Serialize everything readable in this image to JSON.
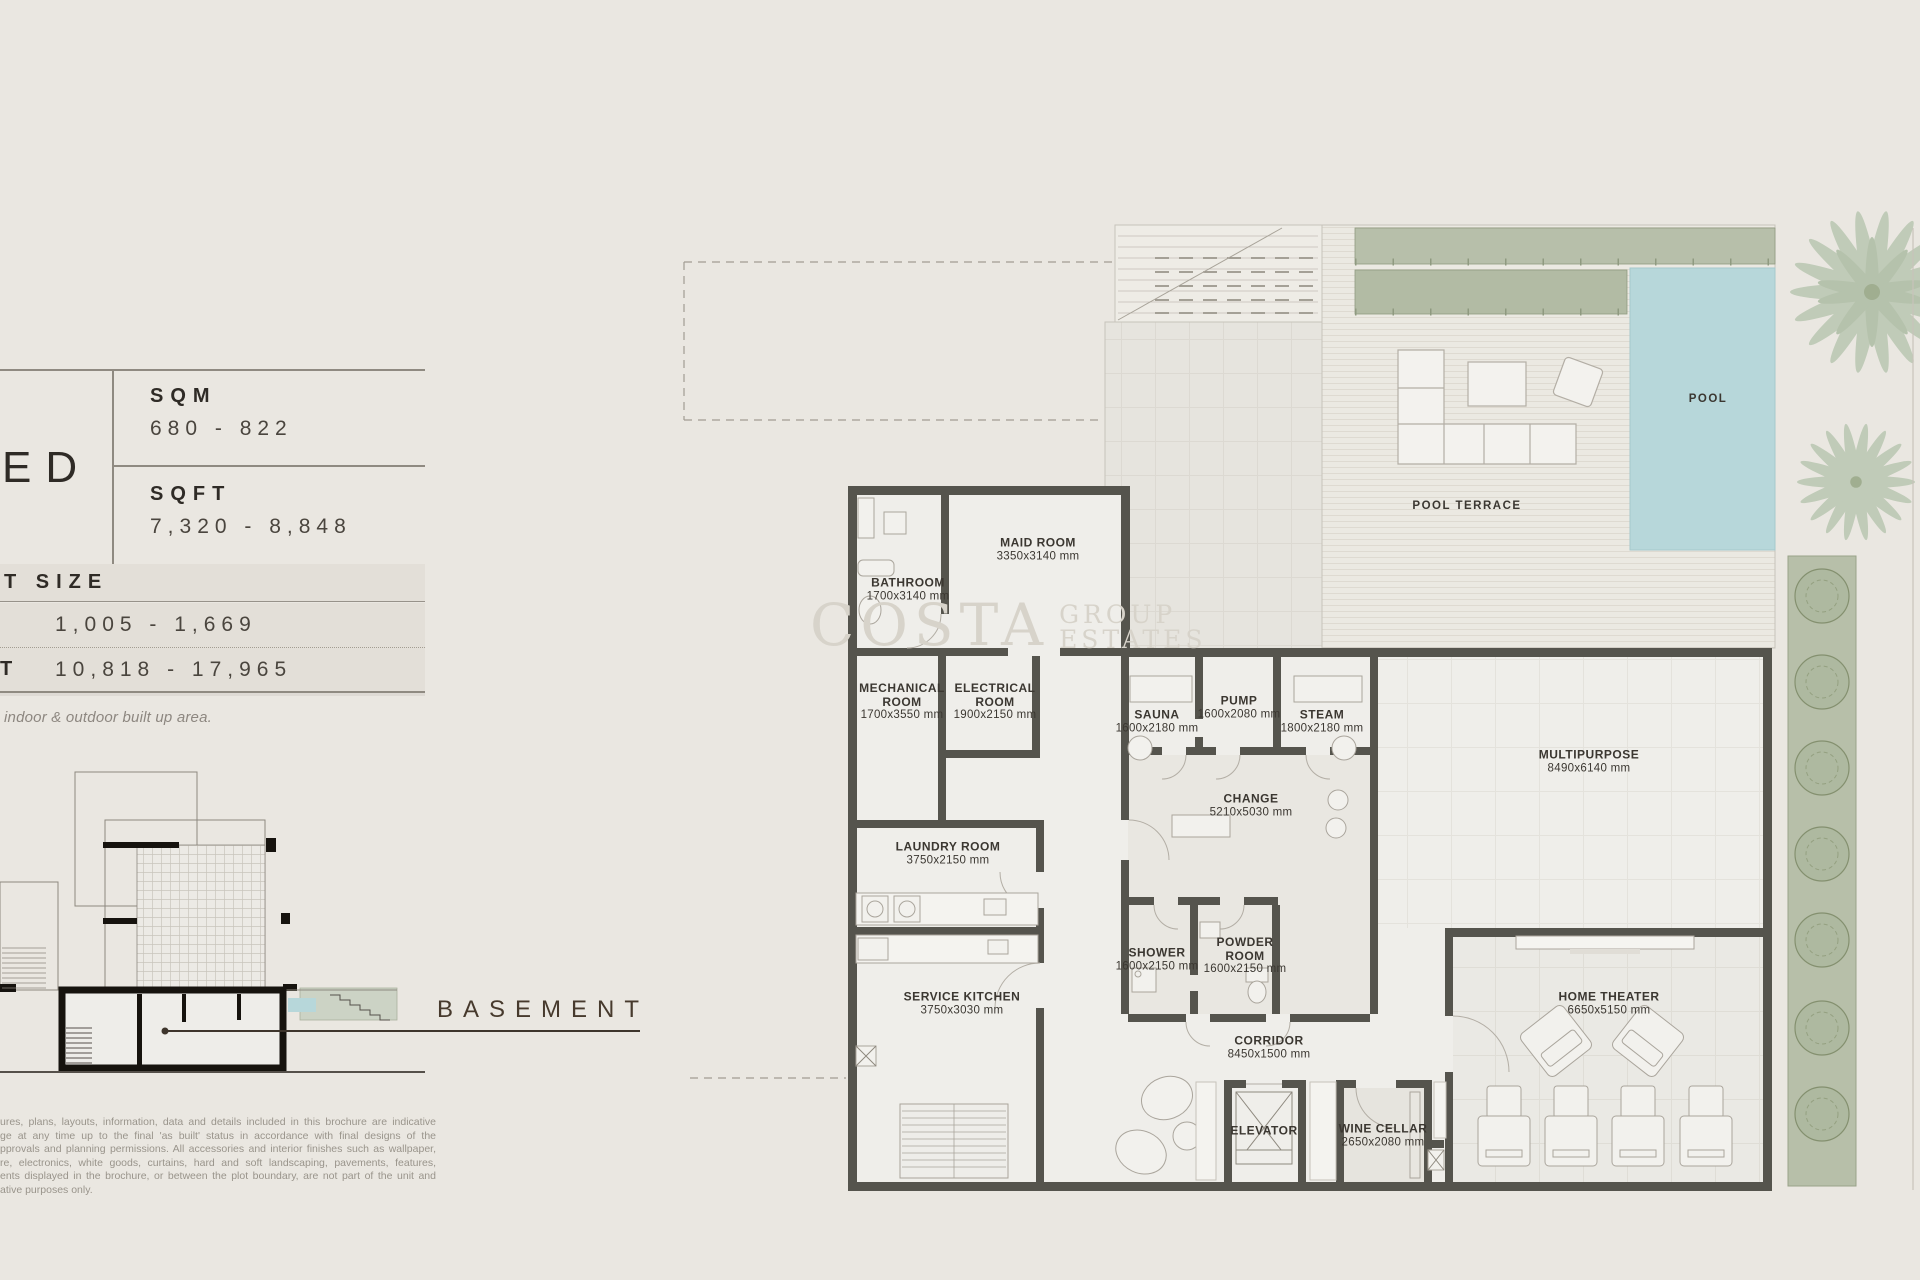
{
  "panel": {
    "bed": "ED",
    "area": {
      "sqm_label": "SQM",
      "sqm_value": "680 - 822",
      "sqft_label": "SQFT",
      "sqft_value": "7,320 - 8,848"
    },
    "plot": {
      "header": "T SIZE",
      "sqm_value": "1,005 - 1,669",
      "sqft_prefix": "T",
      "sqft_value": "10,818 - 17,965"
    },
    "note": "indoor & outdoor built up area.",
    "disclaimer": [
      "ures, plans, layouts, information, data and details included in this brochure are indicative",
      "ge at any time up to the final 'as built' status in accordance with final designs of the",
      "pprovals and planning permissions. All accessories and interior finishes such as wallpaper,",
      "re, electronics, white goods, curtains, hard and soft landscaping, pavements, features,",
      "ents displayed in the brochure, or between the plot boundary, are not part of the unit and",
      "ative purposes only."
    ]
  },
  "section": {
    "label": "BASEMENT"
  },
  "watermark": {
    "name": "COSTA",
    "group": "GROUP",
    "estates": "ESTATES"
  },
  "plan": {
    "outdoor": {
      "pool": "POOL",
      "terrace": "POOL TERRACE"
    },
    "rooms": [
      {
        "name": "MAID ROOM",
        "dims": "3350x3140 mm"
      },
      {
        "name": "BATHROOM",
        "dims": "1700x3140 mm"
      },
      {
        "name": "MECHANICAL ROOM",
        "dims": "1700x3550 mm"
      },
      {
        "name": "ELECTRICAL ROOM",
        "dims": "1900x2150 mm"
      },
      {
        "name": "LAUNDRY ROOM",
        "dims": "3750x2150 mm"
      },
      {
        "name": "SERVICE KITCHEN",
        "dims": "3750x3030 mm"
      },
      {
        "name": "SAUNA",
        "dims": "1600x2180 mm"
      },
      {
        "name": "PUMP",
        "dims": "1600x2080 mm"
      },
      {
        "name": "STEAM",
        "dims": "1800x2180 mm"
      },
      {
        "name": "CHANGE",
        "dims": "5210x5030 mm"
      },
      {
        "name": "SHOWER",
        "dims": "1600x2150 mm"
      },
      {
        "name": "POWDER ROOM",
        "dims": "1600x2150 mm"
      },
      {
        "name": "CORRIDOR",
        "dims": "8450x1500 mm"
      },
      {
        "name": "ELEVATOR",
        "dims": ""
      },
      {
        "name": "WINE CELLAR",
        "dims": "2650x2080 mm"
      },
      {
        "name": "MULTIPURPOSE",
        "dims": "8490x6140 mm"
      },
      {
        "name": "HOME THEATER",
        "dims": "6650x5150 mm"
      }
    ]
  },
  "colors": {
    "page_bg": "#eae7e1",
    "panel_band": "#e3dfd8",
    "wall": "#55544d",
    "floor": "#efeeea",
    "pool_water": "#b7d7da",
    "planter_green": "#b6bfa9",
    "text_dark": "#38342e",
    "text_muted": "#97928a",
    "watermark": "#d7d3ca",
    "basement_label": "#473a2d"
  }
}
